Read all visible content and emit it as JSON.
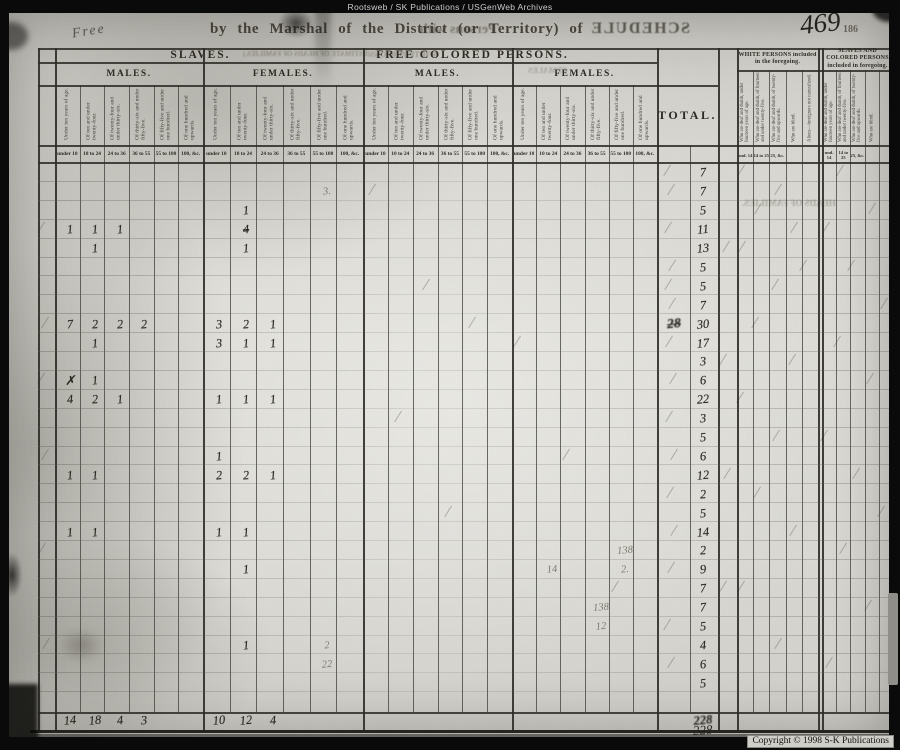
{
  "watermark_top": "Rootsweb / SK Publications / USGenWeb Archives",
  "copyright_notice": "Copyright © 1998 S-K Publications",
  "page_header": {
    "handwritten_word": "Free",
    "printed_line": "by the Marshal of the District (or Territory) of",
    "mirrored_fragment": "Persons with",
    "mirrored_title": "SCHEDULE",
    "page_number_handwritten": "469",
    "page_number_printed": "186"
  },
  "table_header": {
    "slaves_title": "SLAVES.",
    "free_colored_title": "FREE COLORED PERSONS.",
    "males_label": "MALES.",
    "females_label": "FEMALES.",
    "total_label": "TOTAL.",
    "white_included_title": "WHITE PERSONS included in the foregoing.",
    "colored_included_title": "SLAVES AND COLORED PERSONS included in foregoing.",
    "age_columns_rotated": [
      "Under ten years of age.",
      "Of ten and under twenty-four.",
      "Of twenty-four and under thirty-six.",
      "Of thirty-six and under fifty-five.",
      "Of fifty-five and under one hundred.",
      "Of one hundred and upwards."
    ],
    "age_columns_short": [
      "under 10",
      "10 to 24",
      "24 to 36",
      "36 to 55",
      "55 to 100",
      "100, &c."
    ],
    "included_columns_rotated_white": [
      "Who are deaf and dumb, under fourteen years of age.",
      "Who are deaf and dumb, of fourteen and under twenty-five.",
      "Who are deaf and dumb, of twenty-five and upwards.",
      "Who are blind.",
      "Aliens—foreigners not naturalized."
    ],
    "included_columns_rotated_colored": [
      "Who are deaf and dumb, under fourteen years of age.",
      "Who are deaf and dumb, of fourteen and under twenty-five.",
      "Who are deaf and dumb, of twenty-five and upwards.",
      "Who are blind.",
      ""
    ],
    "included_columns_short": [
      "und. 14",
      "14 to 25",
      "25, &c.",
      "",
      ""
    ],
    "mirrored_bleedthrough": {
      "estimate_fragment": "(ESTIMATE OF HEADS OF FAMILIES.)",
      "white_persons_fragment": "WHITE PERSONS",
      "females_fragment": "FEMALES",
      "heads_of_families_fragment": "HEADS OF FAMILIES."
    }
  },
  "entries": {
    "total_column": [
      7,
      7,
      5,
      11,
      13,
      5,
      5,
      7,
      30,
      17,
      3,
      6,
      22,
      3,
      5,
      6,
      12,
      2,
      5,
      14,
      2,
      9,
      7,
      7,
      5,
      4,
      6,
      5
    ],
    "crossed_out_total": {
      "row": 9,
      "value": "28"
    },
    "cell_marks": [
      {
        "c": "sf2",
        "r": 3,
        "v": "1"
      },
      {
        "c": "sm1",
        "r": 4,
        "v": "1"
      },
      {
        "c": "sm2",
        "r": 4,
        "v": "1"
      },
      {
        "c": "sm3",
        "r": 4,
        "v": "1"
      },
      {
        "c": "sf2",
        "r": 4,
        "v": "4",
        "s": "struck"
      },
      {
        "c": "sm2",
        "r": 5,
        "v": "1"
      },
      {
        "c": "sf2",
        "r": 5,
        "v": "1"
      },
      {
        "c": "sm1",
        "r": 9,
        "v": "7"
      },
      {
        "c": "sm2",
        "r": 9,
        "v": "2"
      },
      {
        "c": "sm3",
        "r": 9,
        "v": "2"
      },
      {
        "c": "sm4",
        "r": 9,
        "v": "2"
      },
      {
        "c": "sf1",
        "r": 9,
        "v": "3"
      },
      {
        "c": "sf2",
        "r": 9,
        "v": "2"
      },
      {
        "c": "sf3",
        "r": 9,
        "v": "1"
      },
      {
        "c": "sm2",
        "r": 10,
        "v": "1"
      },
      {
        "c": "sf1",
        "r": 10,
        "v": "3"
      },
      {
        "c": "sf2",
        "r": 10,
        "v": "1"
      },
      {
        "c": "sf3",
        "r": 10,
        "v": "1"
      },
      {
        "c": "sm1",
        "r": 12,
        "v": "✗"
      },
      {
        "c": "sm2",
        "r": 12,
        "v": "1"
      },
      {
        "c": "sm1",
        "r": 13,
        "v": "4"
      },
      {
        "c": "sm2",
        "r": 13,
        "v": "2"
      },
      {
        "c": "sm3",
        "r": 13,
        "v": "1"
      },
      {
        "c": "sf1",
        "r": 13,
        "v": "1"
      },
      {
        "c": "sf2",
        "r": 13,
        "v": "1"
      },
      {
        "c": "sf3",
        "r": 13,
        "v": "1"
      },
      {
        "c": "sf1",
        "r": 16,
        "v": "1"
      },
      {
        "c": "sm1",
        "r": 17,
        "v": "1"
      },
      {
        "c": "sm2",
        "r": 17,
        "v": "1"
      },
      {
        "c": "sf1",
        "r": 17,
        "v": "2"
      },
      {
        "c": "sf2",
        "r": 17,
        "v": "2"
      },
      {
        "c": "sf3",
        "r": 17,
        "v": "1"
      },
      {
        "c": "sm1",
        "r": 20,
        "v": "1"
      },
      {
        "c": "sm2",
        "r": 20,
        "v": "1"
      },
      {
        "c": "sf1",
        "r": 20,
        "v": "1"
      },
      {
        "c": "sf2",
        "r": 20,
        "v": "1"
      },
      {
        "c": "sf2",
        "r": 22,
        "v": "1"
      },
      {
        "c": "sf2",
        "r": 26,
        "v": "1"
      }
    ],
    "pencil_annotations": [
      {
        "c": "sf5",
        "r": 2,
        "v": "3."
      },
      {
        "c": "ff5",
        "r": 21,
        "v": "138"
      },
      {
        "c": "ff5",
        "r": 22,
        "v": "2."
      },
      {
        "c": "ff2",
        "r": 22,
        "v": "14"
      },
      {
        "c": "ff4",
        "r": 24,
        "v": "138"
      },
      {
        "c": "ff4",
        "r": 25,
        "v": "12"
      },
      {
        "c": "sf5",
        "r": 26,
        "v": "2"
      },
      {
        "c": "sf5",
        "r": 27,
        "v": "22"
      }
    ],
    "column_totals": {
      "sm1": "14",
      "sm2": "18",
      "sm3": "4",
      "sm4": "3",
      "sf1": "10",
      "sf2": "12",
      "sf3": "4",
      "total": "228"
    },
    "grand_total_below_line": "228",
    "faint_ticks": [
      [
        "totx",
        1
      ],
      [
        "totx",
        2
      ],
      [
        "totx",
        4
      ],
      [
        "totx",
        6
      ],
      [
        "totx",
        7
      ],
      [
        "totx",
        8
      ],
      [
        "totx",
        10
      ],
      [
        "totx",
        12
      ],
      [
        "totx",
        14
      ],
      [
        "totx",
        16
      ],
      [
        "totx",
        18
      ],
      [
        "totx",
        20
      ],
      [
        "totx",
        22
      ],
      [
        "totx",
        25
      ],
      [
        "totx",
        27
      ],
      [
        "lead",
        4
      ],
      [
        "lead",
        9
      ],
      [
        "lead",
        12
      ],
      [
        "lead",
        16
      ],
      [
        "lead",
        21
      ],
      [
        "lead",
        26
      ],
      [
        "w1",
        1
      ],
      [
        "w3",
        2
      ],
      [
        "w2",
        3
      ],
      [
        "w4",
        4
      ],
      [
        "w1",
        5
      ],
      [
        "w5",
        6
      ],
      [
        "w3",
        7
      ],
      [
        "w2",
        9
      ],
      [
        "w4",
        11
      ],
      [
        "w1",
        13
      ],
      [
        "w3",
        15
      ],
      [
        "w2",
        18
      ],
      [
        "w4",
        20
      ],
      [
        "w1",
        23
      ],
      [
        "w3",
        26
      ],
      [
        "c2",
        1
      ],
      [
        "c4",
        3
      ],
      [
        "c1",
        4
      ],
      [
        "c3",
        6
      ],
      [
        "c5",
        8
      ],
      [
        "c2",
        10
      ],
      [
        "c4",
        12
      ],
      [
        "c1",
        15
      ],
      [
        "c3",
        17
      ],
      [
        "c5",
        19
      ],
      [
        "c2",
        21
      ],
      [
        "c4",
        24
      ],
      [
        "c1",
        27
      ],
      [
        "fm1",
        2
      ],
      [
        "fm3",
        7
      ],
      [
        "fm5",
        9
      ],
      [
        "ff1",
        10
      ],
      [
        "fm2",
        14
      ],
      [
        "ff3",
        16
      ],
      [
        "fm4",
        19
      ],
      [
        "ff5",
        23
      ],
      [
        "gap",
        5
      ],
      [
        "gap",
        11
      ],
      [
        "gap",
        17
      ],
      [
        "gap",
        23
      ]
    ]
  }
}
